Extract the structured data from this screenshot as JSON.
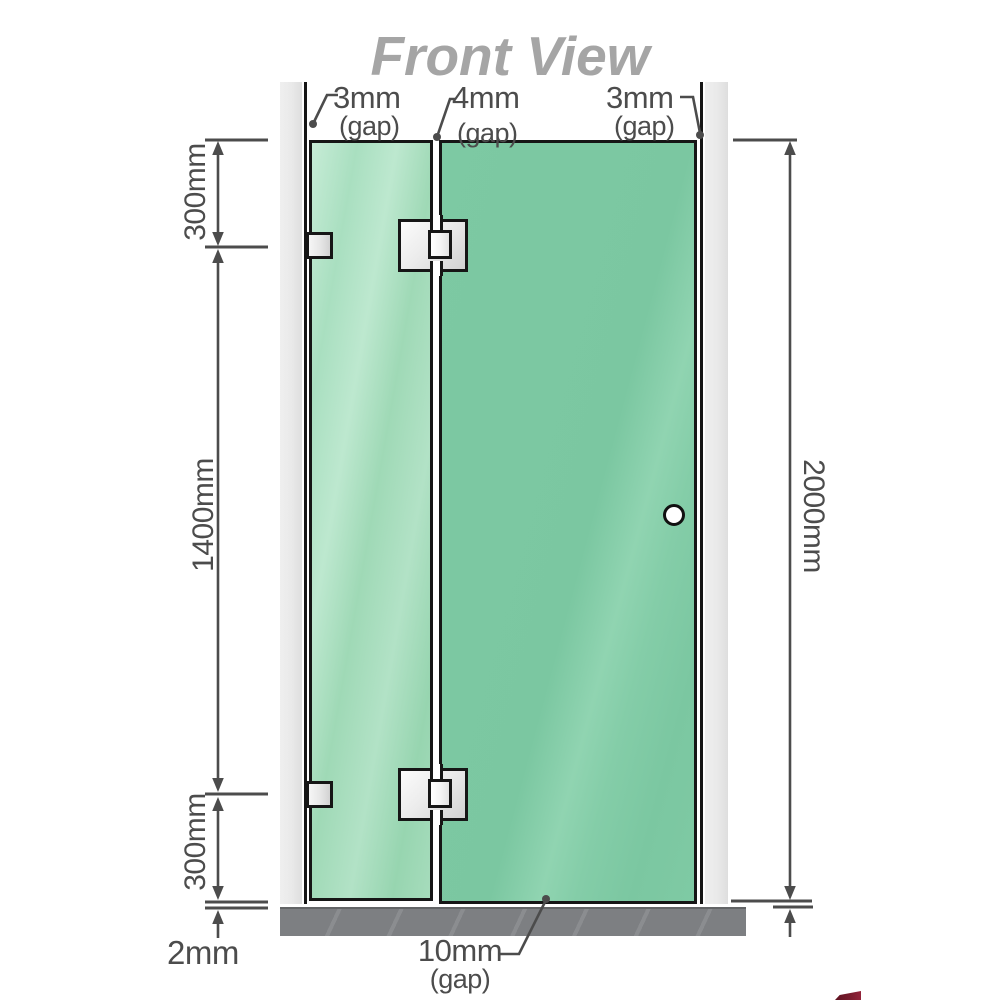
{
  "title": "Front View",
  "annotations": {
    "gap_left": {
      "value": "3mm",
      "unit": "(gap)"
    },
    "gap_middle": {
      "value": "4mm",
      "unit": "(gap)"
    },
    "gap_right": {
      "value": "3mm",
      "unit": "(gap)"
    },
    "gap_bottom": {
      "value": "10mm",
      "unit": "(gap)"
    }
  },
  "dimensions": {
    "top_segment": "300mm",
    "middle_segment": "1400mm",
    "bottom_segment": "300mm",
    "total_height": "2000mm",
    "floor_clearance": "2mm"
  },
  "colors": {
    "glass_green": "#7cc8a2",
    "glass_green_light": "#b5e4c8",
    "wall_gray": "#eaeaea",
    "floor_gray": "#7e8083",
    "line_dark": "#161616",
    "dimension_gray": "#4c4c4c",
    "title_gray": "#a5a5a5",
    "hinge_silver": "#e6e6e6",
    "logo_red": "#7a1c2e"
  }
}
